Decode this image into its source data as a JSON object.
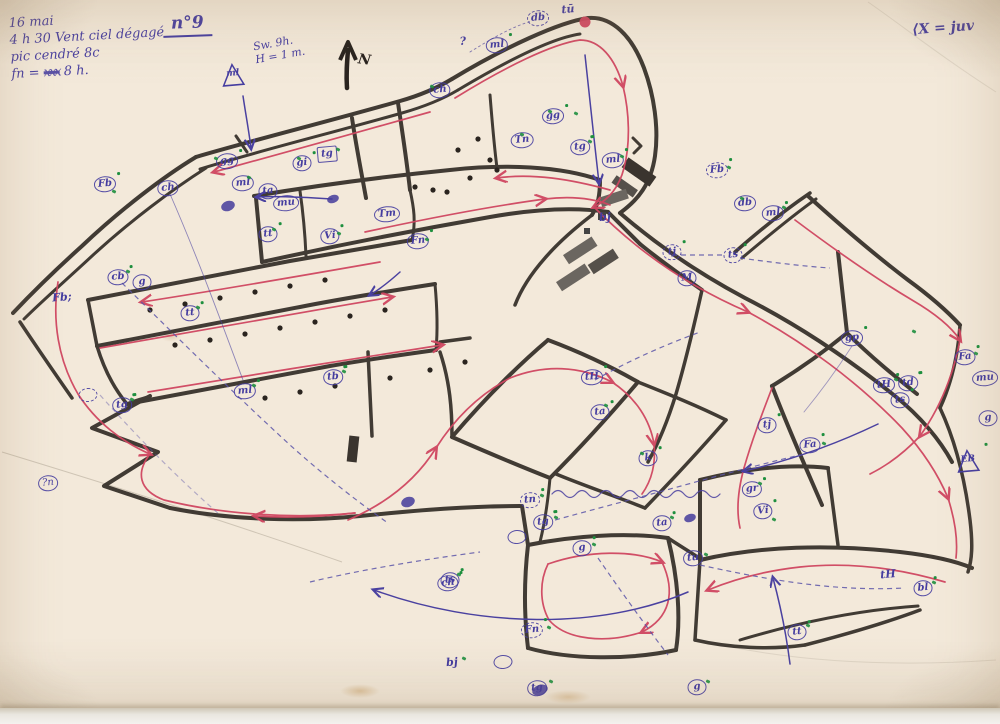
{
  "title": "n°9",
  "notes": {
    "date_line": "16 mai",
    "weather_line": "4 h 30  Vent  ciel dégagé",
    "species_line": "pic cendré  8c",
    "time_prefix": "fn = ",
    "time_struck": "xxx",
    "time_suffix": " 8 h.",
    "wind_line1": "Sw. 9h.",
    "wind_line2": "H = 1 m.",
    "wind_triangle_label": "ml",
    "legend_right": "⟨X  =  juv",
    "north_label": "N"
  },
  "colors": {
    "paper": "#f3e9da",
    "ink_blue": "#453da0",
    "route_red": "#cf4660",
    "boundary_black": "#322c26",
    "mark_green": "#1e8f3e"
  },
  "map": {
    "labels": [
      {
        "t": "?n",
        "x": 48,
        "y": 483,
        "s": "thin"
      },
      {
        "t": "Fb",
        "x": 105,
        "y": 184,
        "s": "circle",
        "g": 1
      },
      {
        "t": "ch",
        "x": 168,
        "y": 188,
        "s": "circle"
      },
      {
        "t": "gg",
        "x": 227,
        "y": 161,
        "s": "circle",
        "g": 1
      },
      {
        "t": "ml",
        "x": 243,
        "y": 183,
        "s": "circle"
      },
      {
        "t": "ta",
        "x": 268,
        "y": 191,
        "s": "circle"
      },
      {
        "t": "mu",
        "x": 286,
        "y": 203,
        "s": "circle"
      },
      {
        "t": "gi",
        "x": 302,
        "y": 163,
        "s": "circle",
        "g": 1
      },
      {
        "t": "tg",
        "x": 327,
        "y": 154,
        "s": "square"
      },
      {
        "t": "tt",
        "x": 268,
        "y": 234,
        "s": "circle",
        "g": 1
      },
      {
        "t": "tt",
        "x": 190,
        "y": 313,
        "s": "circle",
        "g": 1
      },
      {
        "t": "cb",
        "x": 118,
        "y": 277,
        "s": "circle",
        "g": 1
      },
      {
        "t": "g",
        "x": 142,
        "y": 282,
        "s": "circle"
      },
      {
        "t": "Fb;",
        "x": 62,
        "y": 298,
        "s": "plain"
      },
      {
        "t": "tg",
        "x": 122,
        "y": 405,
        "s": "circle",
        "g": 1
      },
      {
        "t": "",
        "x": 88,
        "y": 395,
        "s": "dashed"
      },
      {
        "t": "ml",
        "x": 245,
        "y": 391,
        "s": "circle",
        "g": 1
      },
      {
        "t": "tb",
        "x": 333,
        "y": 377,
        "s": "circle",
        "g": 1
      },
      {
        "t": "Tm",
        "x": 387,
        "y": 214,
        "s": "circle"
      },
      {
        "t": "Fn",
        "x": 418,
        "y": 241,
        "s": "circle",
        "g": 1
      },
      {
        "t": "Vi",
        "x": 330,
        "y": 236,
        "s": "circle",
        "g": 1
      },
      {
        "t": "ch",
        "x": 440,
        "y": 90,
        "s": "circle"
      },
      {
        "t": "ml",
        "x": 497,
        "y": 45,
        "s": "circle",
        "g": 1
      },
      {
        "t": "?",
        "x": 463,
        "y": 42,
        "s": "plain"
      },
      {
        "t": "db",
        "x": 538,
        "y": 18,
        "s": "dashed"
      },
      {
        "t": "tū",
        "x": 568,
        "y": 10,
        "s": "plain"
      },
      {
        "t": "gg",
        "x": 553,
        "y": 116,
        "s": "circle",
        "g": 1
      },
      {
        "t": "Tn",
        "x": 522,
        "y": 140,
        "s": "circle"
      },
      {
        "t": "tg",
        "x": 580,
        "y": 147,
        "s": "circle",
        "g": 1
      },
      {
        "t": "ml",
        "x": 613,
        "y": 160,
        "s": "circle",
        "g": 1
      },
      {
        "t": "bj",
        "x": 605,
        "y": 218,
        "s": "plain"
      },
      {
        "t": "tj",
        "x": 672,
        "y": 252,
        "s": "dashed",
        "g": 1
      },
      {
        "t": "ts",
        "x": 733,
        "y": 255,
        "s": "dashed",
        "g": 1
      },
      {
        "t": "M",
        "x": 687,
        "y": 278,
        "s": "circle"
      },
      {
        "t": "Fb",
        "x": 717,
        "y": 170,
        "s": "dashed",
        "g": 1
      },
      {
        "t": "db",
        "x": 745,
        "y": 203,
        "s": "circle"
      },
      {
        "t": "ml",
        "x": 773,
        "y": 213,
        "s": "circle",
        "g": 1
      },
      {
        "t": "gp",
        "x": 852,
        "y": 338,
        "s": "circle",
        "g": 1
      },
      {
        "t": "tH",
        "x": 884,
        "y": 385,
        "s": "circle",
        "g": 1
      },
      {
        "t": "td",
        "x": 908,
        "y": 383,
        "s": "circle",
        "g": 1
      },
      {
        "t": "ts",
        "x": 900,
        "y": 400,
        "s": "circle",
        "g": 1
      },
      {
        "t": "Fa",
        "x": 965,
        "y": 357,
        "s": "circle",
        "g": 1
      },
      {
        "t": "mu",
        "x": 985,
        "y": 378,
        "s": "circle"
      },
      {
        "t": "g",
        "x": 988,
        "y": 418,
        "s": "circle"
      },
      {
        "t": "EB",
        "x": 968,
        "y": 462,
        "s": "tri",
        "g": 1
      },
      {
        "t": "tH",
        "x": 592,
        "y": 377,
        "s": "circle",
        "g": 1
      },
      {
        "t": "ta",
        "x": 600,
        "y": 412,
        "s": "circle",
        "g": 1
      },
      {
        "t": "k",
        "x": 648,
        "y": 458,
        "s": "circle",
        "g": 1
      },
      {
        "t": "tj",
        "x": 767,
        "y": 425,
        "s": "circle",
        "g": 1
      },
      {
        "t": "Fa",
        "x": 810,
        "y": 445,
        "s": "circle",
        "g": 1
      },
      {
        "t": "gr",
        "x": 752,
        "y": 489,
        "s": "circle",
        "g": 1
      },
      {
        "t": "Vi",
        "x": 763,
        "y": 511,
        "s": "circle",
        "g": 1
      },
      {
        "t": "ts",
        "x": 450,
        "y": 580,
        "s": "circle",
        "g": 1
      },
      {
        "t": "tn",
        "x": 530,
        "y": 500,
        "s": "dashed",
        "g": 1
      },
      {
        "t": "tg",
        "x": 543,
        "y": 522,
        "s": "circle",
        "g": 1
      },
      {
        "t": "",
        "x": 517,
        "y": 537,
        "s": "thin"
      },
      {
        "t": "g",
        "x": 582,
        "y": 548,
        "s": "circle",
        "g": 1
      },
      {
        "t": "ta",
        "x": 662,
        "y": 523,
        "s": "circle",
        "g": 1
      },
      {
        "t": "tu",
        "x": 693,
        "y": 558,
        "s": "circle"
      },
      {
        "t": "ch",
        "x": 448,
        "y": 583,
        "s": "circle",
        "g": 1
      },
      {
        "t": "Fn",
        "x": 532,
        "y": 630,
        "s": "dashed",
        "g": 1
      },
      {
        "t": "bj",
        "x": 452,
        "y": 663,
        "s": "plain"
      },
      {
        "t": "",
        "x": 503,
        "y": 662,
        "s": "thin"
      },
      {
        "t": "tg",
        "x": 537,
        "y": 688,
        "s": "circle"
      },
      {
        "t": "g",
        "x": 697,
        "y": 687,
        "s": "circle"
      },
      {
        "t": "tt",
        "x": 797,
        "y": 632,
        "s": "circle",
        "g": 1
      },
      {
        "t": "tH",
        "x": 888,
        "y": 575,
        "s": "plain"
      },
      {
        "t": "bl",
        "x": 923,
        "y": 588,
        "s": "circle",
        "g": 1
      },
      {
        "t": "ml",
        "x": 233,
        "y": 76,
        "s": "tri"
      }
    ],
    "green_marks": [
      [
        112,
        190
      ],
      [
        214,
        157
      ],
      [
        247,
        176
      ],
      [
        297,
        157
      ],
      [
        336,
        148
      ],
      [
        430,
        85
      ],
      [
        520,
        133
      ],
      [
        548,
        110
      ],
      [
        574,
        112
      ],
      [
        588,
        140
      ],
      [
        620,
        155
      ],
      [
        727,
        166
      ],
      [
        740,
        197
      ],
      [
        782,
        206
      ],
      [
        912,
        330
      ],
      [
        974,
        352
      ],
      [
        894,
        378
      ],
      [
        640,
        452
      ],
      [
        604,
        404
      ],
      [
        758,
        482
      ],
      [
        772,
        518
      ],
      [
        822,
        442
      ],
      [
        457,
        573
      ],
      [
        540,
        494
      ],
      [
        554,
        516
      ],
      [
        592,
        543
      ],
      [
        670,
        516
      ],
      [
        704,
        553
      ],
      [
        547,
        626
      ],
      [
        462,
        657
      ],
      [
        549,
        680
      ],
      [
        706,
        680
      ],
      [
        806,
        624
      ],
      [
        932,
        581
      ],
      [
        130,
        398
      ],
      [
        252,
        384
      ],
      [
        342,
        370
      ],
      [
        196,
        306
      ],
      [
        272,
        228
      ],
      [
        126,
        270
      ],
      [
        425,
        238
      ],
      [
        337,
        232
      ]
    ],
    "ink_blobs": [
      [
        228,
        206,
        14,
        10
      ],
      [
        333,
        199,
        12,
        8
      ],
      [
        408,
        502,
        14,
        10
      ],
      [
        690,
        518,
        12,
        8
      ],
      [
        540,
        690,
        16,
        10
      ]
    ]
  }
}
